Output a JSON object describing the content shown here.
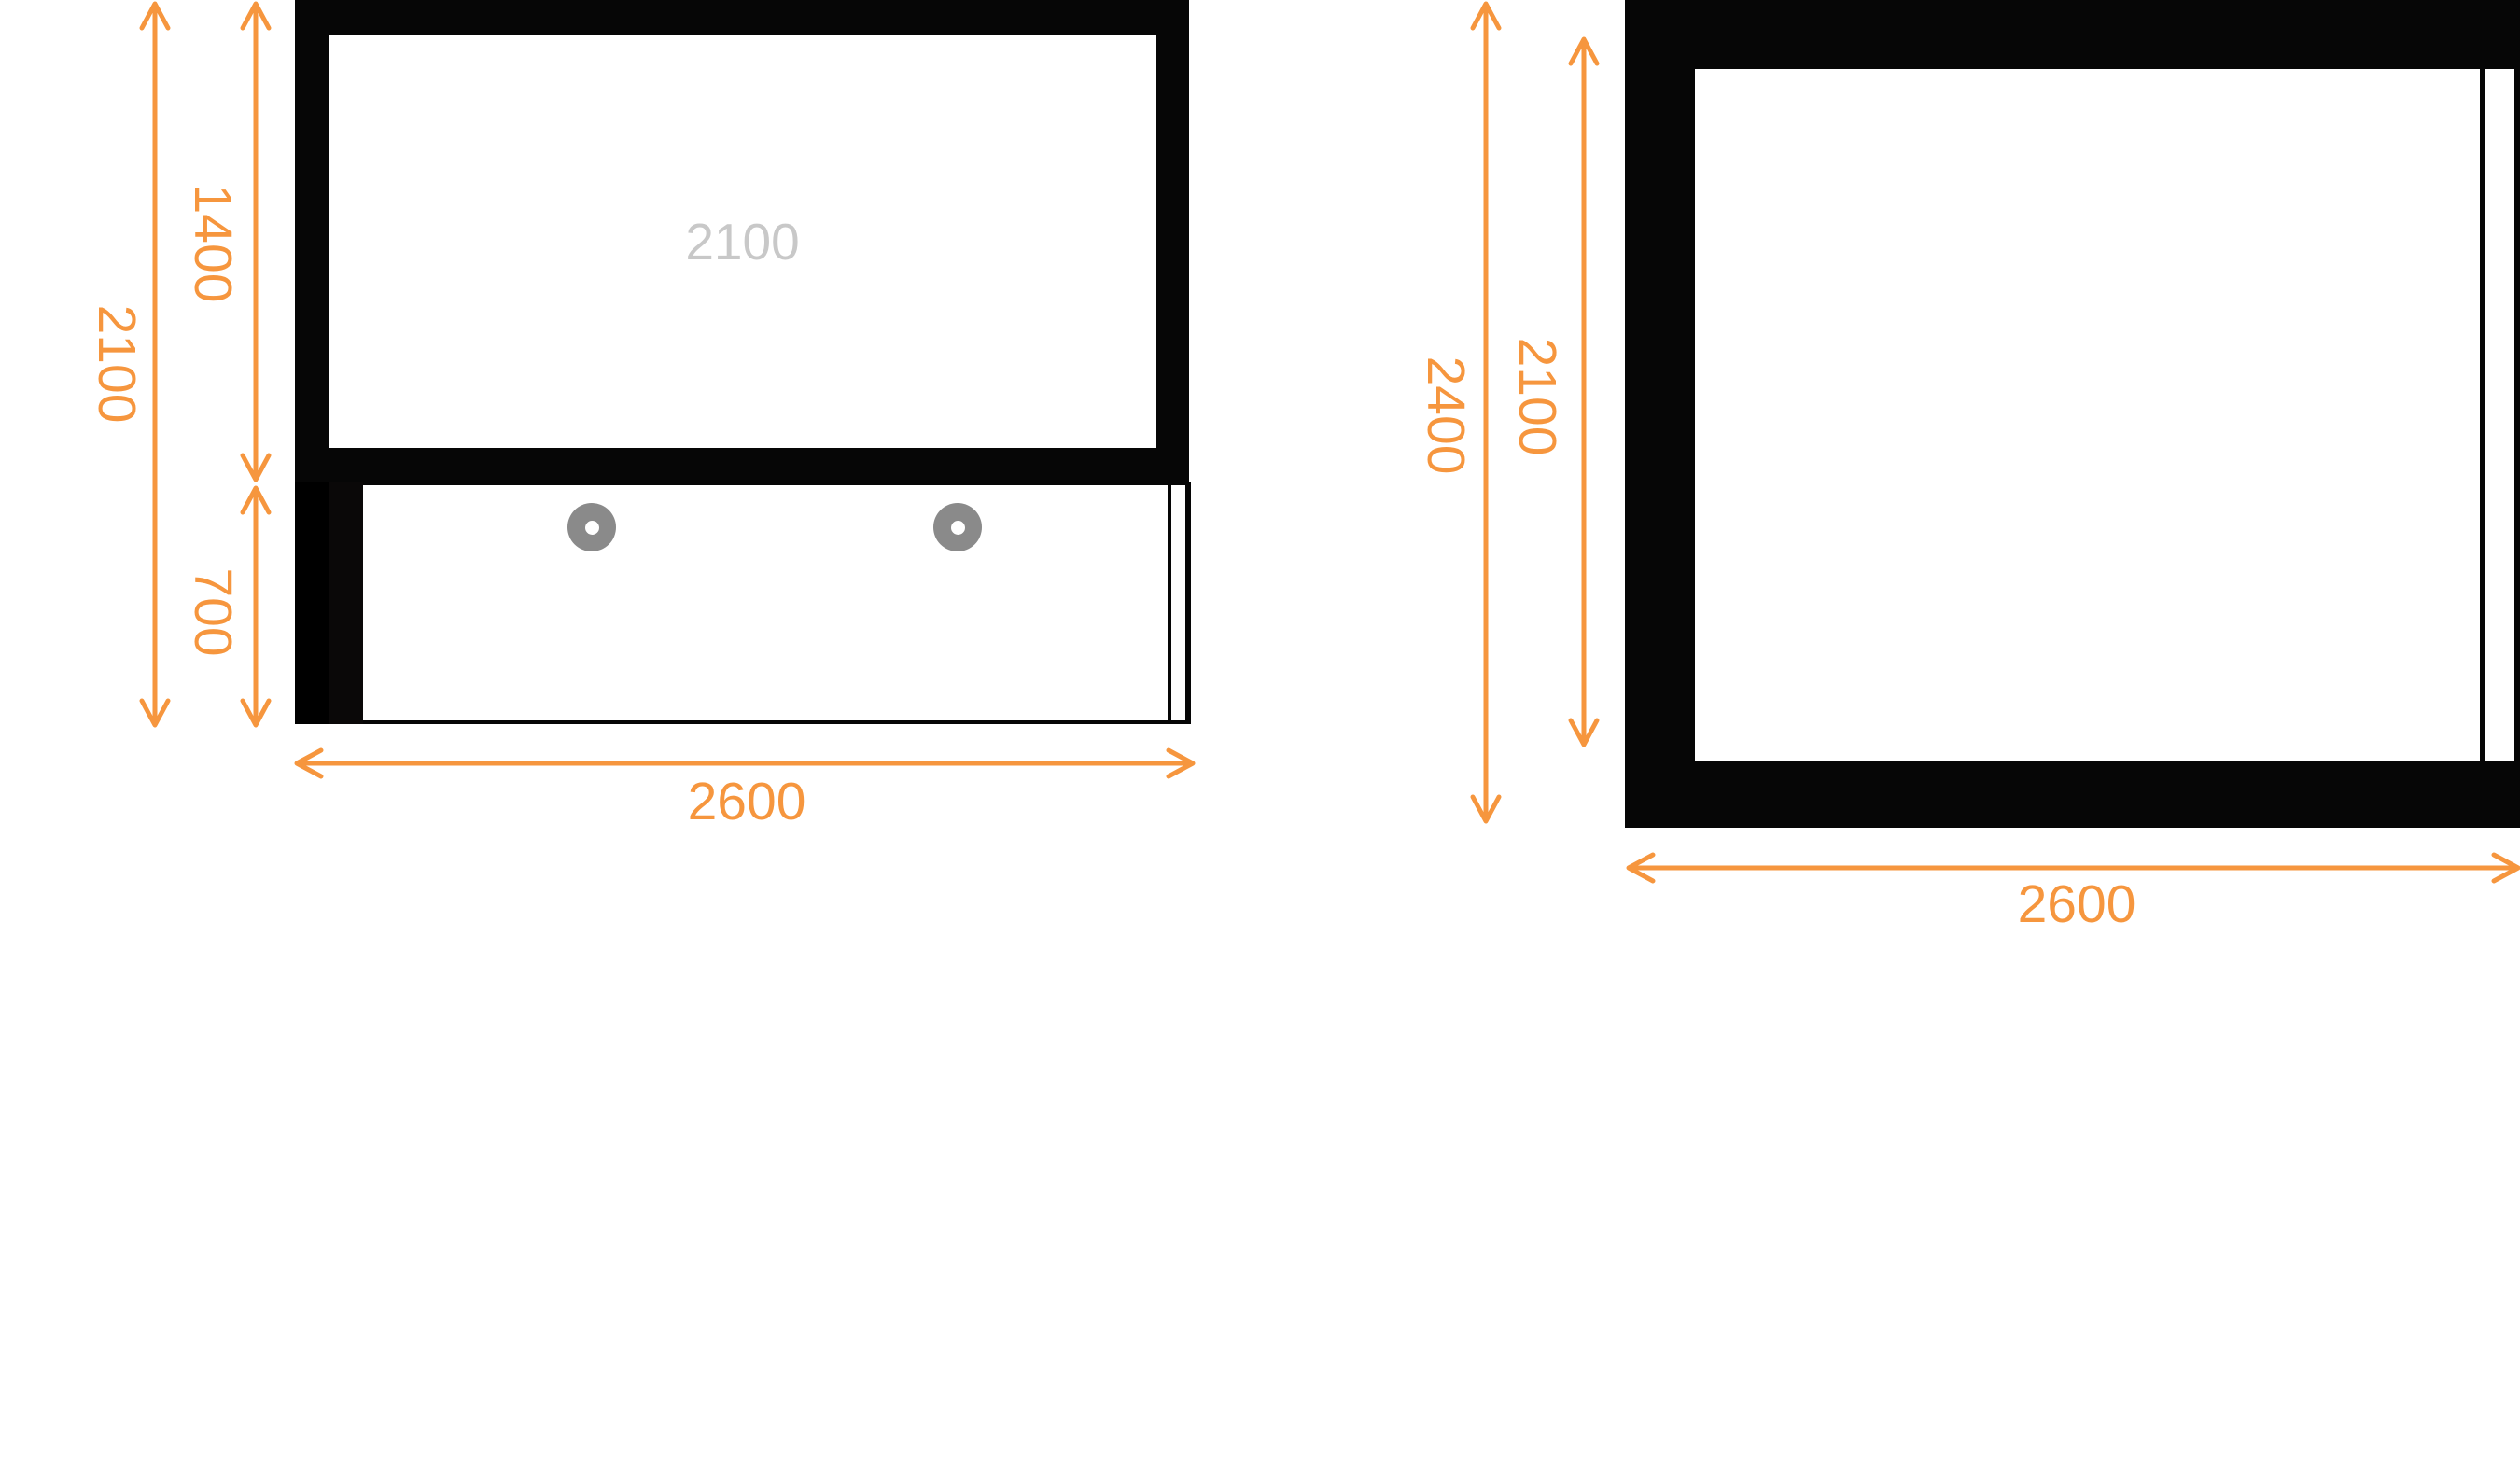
{
  "canvas": {
    "front_view": {
      "panel_placeholder": "2100",
      "dims": {
        "total_height": "2100",
        "upper_height": "1400",
        "lower_height": "700",
        "width": "2600"
      }
    },
    "side_view": {
      "dims": {
        "outer_height": "2400",
        "inner_height": "2100",
        "width": "2600"
      }
    },
    "colors": {
      "dimension_orange": "#F6963E",
      "placeholder_gray": "#C8C8C8",
      "handle_gray": "#8A8A8A",
      "panel_black": "#060606"
    }
  }
}
